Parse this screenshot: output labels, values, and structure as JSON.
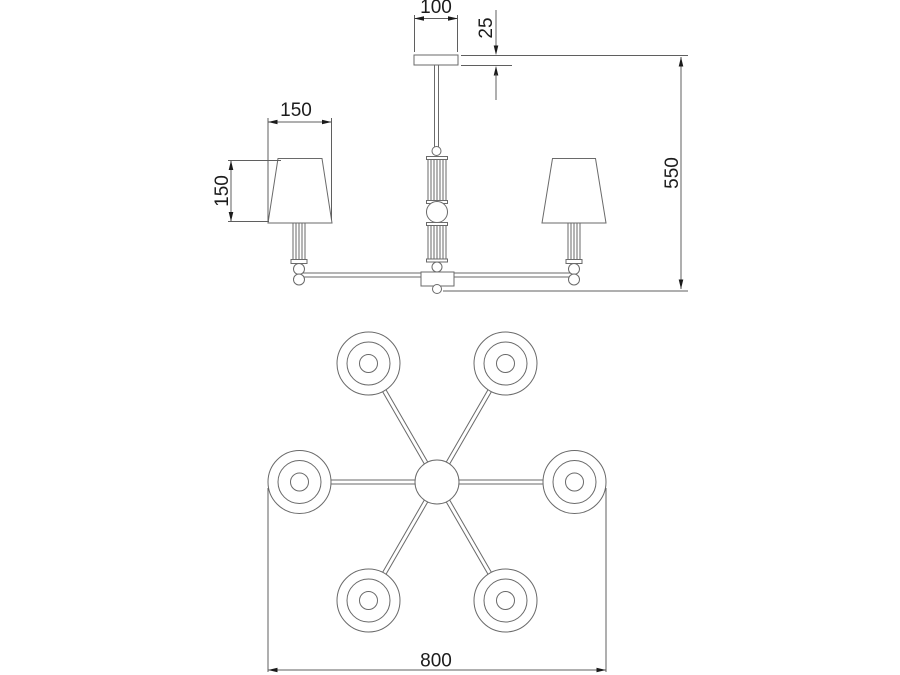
{
  "drawing": {
    "kind": "chandelier-dimension-drawing",
    "lamp_count": 6,
    "colors": {
      "background": "#ffffff",
      "line": "#6a6a6a",
      "text": "#1c1c1c"
    },
    "dims": {
      "canopy_width": "100",
      "canopy_height": "25",
      "shade_width": "150",
      "shade_height": "150",
      "overall_height": "550",
      "overall_diameter": "800"
    }
  }
}
